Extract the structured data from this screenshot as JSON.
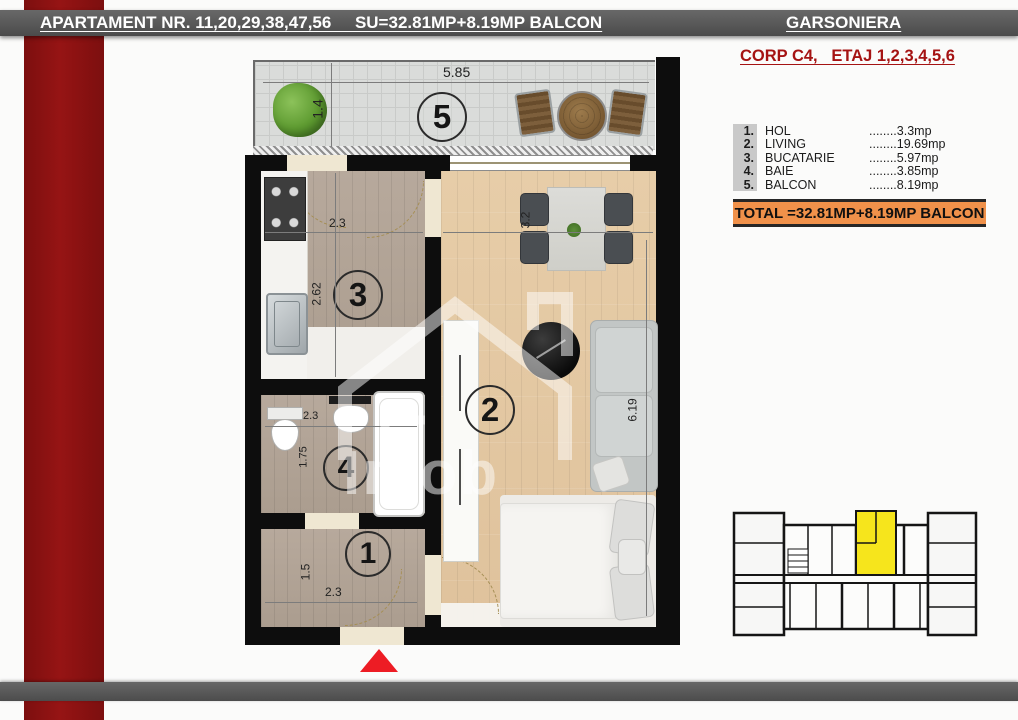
{
  "header": {
    "title": "APARTAMENT NR. 11,20,29,38,47,56     SU=32.81MP+8.19MP BALCON",
    "type_label": "GARSONIERA",
    "corp_floor": "CORP C4,   ETAJ 1,2,3,4,5,6"
  },
  "legend": {
    "rows": [
      {
        "num": "1.",
        "name": "HOL",
        "value": "........3.3mp"
      },
      {
        "num": "2.",
        "name": "LIVING",
        "value": "........19.69mp"
      },
      {
        "num": "3.",
        "name": "BUCATARIE",
        "value": "........5.97mp"
      },
      {
        "num": "4.",
        "name": "BAIE",
        "value": "........3.85mp"
      },
      {
        "num": "5.",
        "name": "BALCON",
        "value": "........8.19mp"
      }
    ],
    "total": "TOTAL =32.81MP+8.19MP BALCON"
  },
  "plan": {
    "watermark": "Imob",
    "rooms": [
      {
        "number": "1",
        "name": "HOL",
        "width": "2.3",
        "depth": "1.5"
      },
      {
        "number": "2",
        "name": "LIVING",
        "width": "3.2",
        "depth": "6.19"
      },
      {
        "number": "3",
        "name": "BUCATARIE",
        "width": "2.3",
        "depth": "2.62"
      },
      {
        "number": "4",
        "name": "BAIE",
        "width": "2.3",
        "depth": "1.75"
      },
      {
        "number": "5",
        "name": "BALCON",
        "width": "5.85",
        "depth": "1.4"
      }
    ]
  },
  "colors": {
    "brand_red": "#8e1212",
    "bar_gray": "#555555",
    "corp_red": "#a51313",
    "total_orange": "#f0914a",
    "unit_highlight": "#f6e51c",
    "entrance_marker": "#ed1c24"
  }
}
